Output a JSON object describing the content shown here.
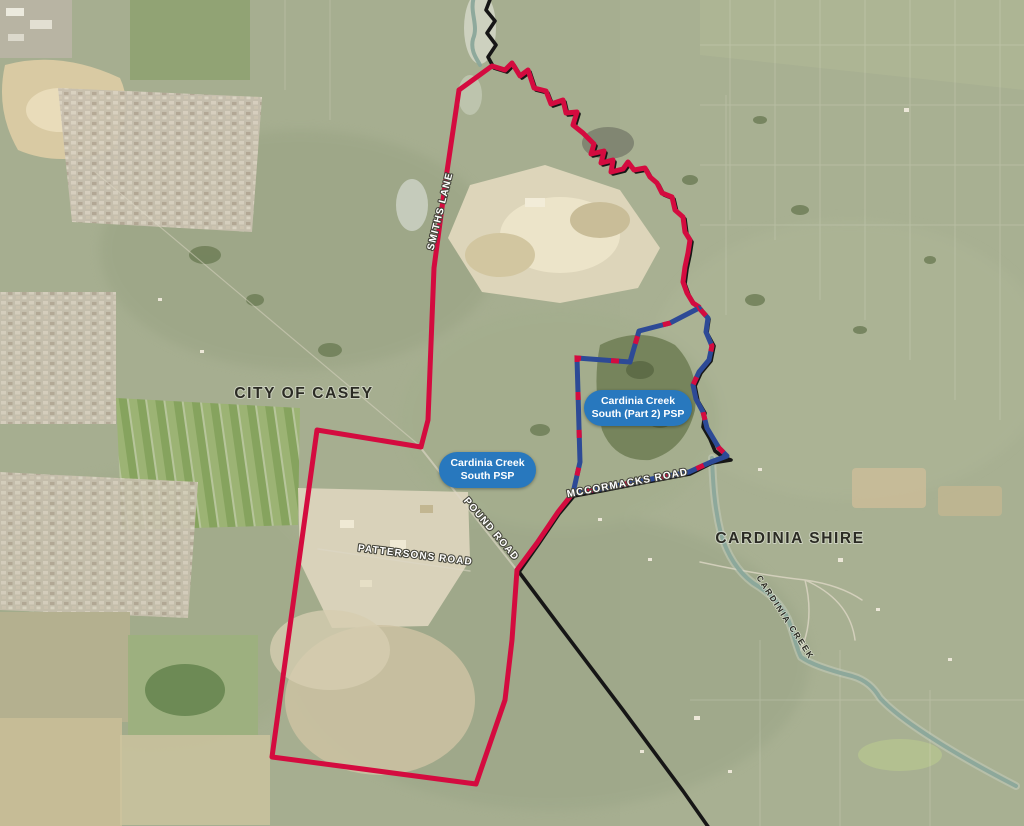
{
  "map": {
    "region_labels": [
      {
        "text": "CITY OF CASEY"
      },
      {
        "text": "CARDINIA SHIRE"
      }
    ],
    "road_labels": [
      {
        "text": "SMITHS LANE"
      },
      {
        "text": "POUND ROAD"
      },
      {
        "text": "PATTERSONS ROAD"
      },
      {
        "text": "MCCORMACKS ROAD"
      }
    ],
    "water_labels": [
      {
        "text": "CARDINIA CREEK"
      }
    ],
    "badges": [
      {
        "line1": "Cardinia Creek",
        "line2": "South PSP"
      },
      {
        "line1": "Cardinia Creek",
        "line2": "South (Part 2) PSP"
      }
    ],
    "colors": {
      "psp_boundary_red": "#d40b3f",
      "part2_boundary_blue": "#2d4a96",
      "municipal_boundary_black": "#161616",
      "creek_teal": "#8aa79a",
      "badge_blue": "#2878be",
      "badge_text": "#ffffff",
      "road_label_fill": "#ffffff",
      "region_label_fill": "#2b2b24"
    },
    "boundaries": {
      "municipal": {
        "path": "M 491 -3 L 486 10 L 495 21 L 487 33 L 496 45 L 488 57 L 494 68 L 507 72 L 514 65 L 522 78 L 530 72 L 536 90 L 548 93 L 553 106 L 565 102 L 568 115 L 579 114 L 575 127 L 585 135 L 596 146 L 593 156 L 606 153 L 603 165 L 615 162 L 613 174 L 625 171 L 630 164 L 636 172 L 647 170 L 652 179 L 659 185 L 664 195 L 674 199 L 677 212 L 685 219 L 687 234 L 692 242 L 690 255 L 687 269 L 685 284 L 689 295 L 695 305 L 701 309 L 709 319 L 707 333 L 714 346 L 711 361 L 701 373 L 695 386 L 698 401 L 705 413 L 703 427 L 710 439 L 715 451 L 723 457 L 731 460 L 712 463 L 690 474 L 642 483 L 601 491 L 574 496 L 559 514 L 538 545 L 519 572 L 561 628 L 623 710 L 683 791 L 709 828"
      },
      "psp_south": {
        "path": "M 459 90 L 445 185 L 434 268 L 428 420 L 421 447 L 317 430 L 272 757 L 476 784 L 505 700 L 512 640 L 517 570 L 537 543 L 558 512 L 573 493",
        "creek_segment_path": "M 459 90 L 492 66 L 505 70 L 512 63 L 520 76 L 528 70 L 534 88 L 546 91 L 551 104 L 563 100 L 566 113 L 577 112 L 573 125 L 583 133 L 594 144 L 591 154 L 604 151 L 601 163 L 613 160 L 611 172 L 623 169 L 628 162 L 634 170 L 645 168 L 650 177 L 657 183 L 662 193 L 672 197 L 675 210 L 683 217 L 685 232 L 690 240 L 688 253 L 685 267 L 683 282 L 687 293 L 693 303 L 699 307"
      },
      "psp_part2": {
        "path": "M 699 308 L 670 323 L 639 331 L 630 362 L 577 358 L 580 462 L 573 493 L 600 489 L 641 481 L 689 472 L 711 462 L 727 456 L 719 448 L 707 428 L 703 412 L 696 399 L 693 385 L 699 372 L 709 360 L 712 346 L 706 332 L 708 318 Z"
      },
      "creek": {
        "path_upper": "M 474 -3 C 469 12 479 25 473 39 C 470 51 477 59 480 65",
        "path_lower": "M 712 458 C 713 482 714 506 721 534 C 727 554 737 571 753 583 C 771 594 781 604 788 619 C 794 634 796 647 801 657 C 812 665 832 671 852 676 C 866 680 874 688 880 698 C 900 720 952 753 1016 786"
      }
    }
  }
}
